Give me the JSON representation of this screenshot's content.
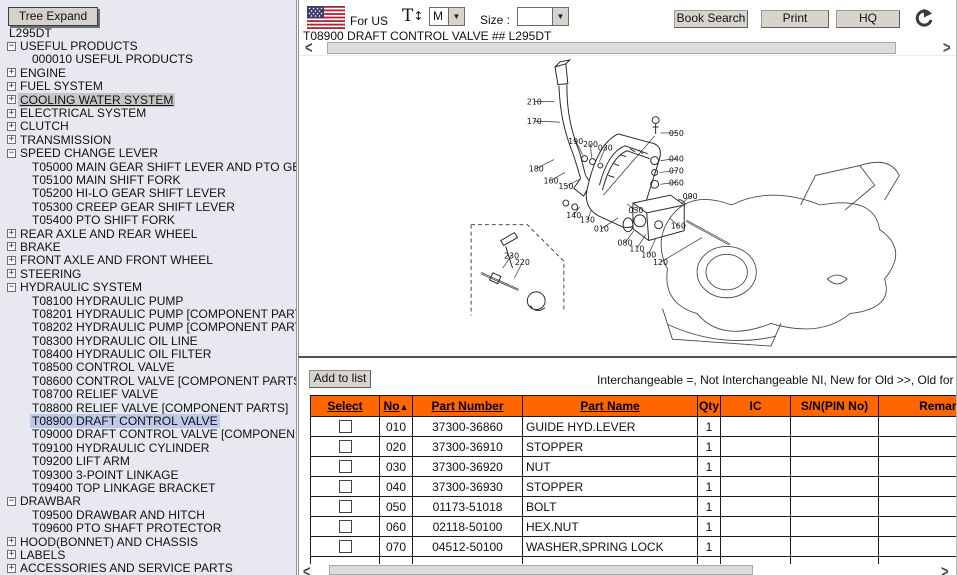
{
  "tree": {
    "expand_button_label": "Tree Expand",
    "items": [
      {
        "label": "L295DT",
        "icon": "none",
        "level": 0,
        "state": "normal"
      },
      {
        "label": "USEFUL PRODUCTS",
        "icon": "minus",
        "level": 0,
        "state": "normal"
      },
      {
        "label": "000010 USEFUL PRODUCTS",
        "icon": "none",
        "level": 1,
        "state": "normal"
      },
      {
        "label": "ENGINE",
        "icon": "plus",
        "level": 0,
        "state": "normal"
      },
      {
        "label": "FUEL SYSTEM",
        "icon": "plus",
        "level": 0,
        "state": "normal"
      },
      {
        "label": "COOLING WATER SYSTEM",
        "icon": "plus",
        "level": 0,
        "state": "focused"
      },
      {
        "label": "ELECTRICAL SYSTEM",
        "icon": "plus",
        "level": 0,
        "state": "normal"
      },
      {
        "label": "CLUTCH",
        "icon": "plus",
        "level": 0,
        "state": "normal"
      },
      {
        "label": "TRANSMISSION",
        "icon": "plus",
        "level": 0,
        "state": "normal"
      },
      {
        "label": "SPEED CHANGE LEVER",
        "icon": "minus",
        "level": 0,
        "state": "normal"
      },
      {
        "label": "T05000 MAIN GEAR SHIFT LEVER AND PTO GE",
        "icon": "none",
        "level": 1,
        "state": "normal"
      },
      {
        "label": "T05100 MAIN SHIFT FORK",
        "icon": "none",
        "level": 1,
        "state": "normal"
      },
      {
        "label": "T05200 HI-LO GEAR SHIFT LEVER",
        "icon": "none",
        "level": 1,
        "state": "normal"
      },
      {
        "label": "T05300 CREEP GEAR SHIFT LEVER",
        "icon": "none",
        "level": 1,
        "state": "normal"
      },
      {
        "label": "T05400 PTO SHIFT FORK",
        "icon": "none",
        "level": 1,
        "state": "normal"
      },
      {
        "label": "REAR AXLE AND REAR WHEEL",
        "icon": "plus",
        "level": 0,
        "state": "normal"
      },
      {
        "label": "BRAKE",
        "icon": "plus",
        "level": 0,
        "state": "normal"
      },
      {
        "label": "FRONT AXLE AND FRONT WHEEL",
        "icon": "plus",
        "level": 0,
        "state": "normal"
      },
      {
        "label": "STEERING",
        "icon": "plus",
        "level": 0,
        "state": "normal"
      },
      {
        "label": "HYDRAULIC SYSTEM",
        "icon": "minus",
        "level": 0,
        "state": "normal"
      },
      {
        "label": "T08100 HYDRAULIC PUMP",
        "icon": "none",
        "level": 1,
        "state": "normal"
      },
      {
        "label": "T08201 HYDRAULIC PUMP [COMPONENT PART",
        "icon": "none",
        "level": 1,
        "state": "normal"
      },
      {
        "label": "T08202 HYDRAULIC PUMP [COMPONENT PART",
        "icon": "none",
        "level": 1,
        "state": "normal"
      },
      {
        "label": "T08300 HYDRAULIC OIL LINE",
        "icon": "none",
        "level": 1,
        "state": "normal"
      },
      {
        "label": "T08400 HYDRAULIC OIL FILTER",
        "icon": "none",
        "level": 1,
        "state": "normal"
      },
      {
        "label": "T08500 CONTROL VALVE",
        "icon": "none",
        "level": 1,
        "state": "normal"
      },
      {
        "label": "T08600 CONTROL VALVE [COMPONENT PARTS",
        "icon": "none",
        "level": 1,
        "state": "normal"
      },
      {
        "label": "T08700 RELIEF VALVE",
        "icon": "none",
        "level": 1,
        "state": "normal"
      },
      {
        "label": "T08800 RELIEF VALVE [COMPONENT PARTS]",
        "icon": "none",
        "level": 1,
        "state": "normal"
      },
      {
        "label": "T08900 DRAFT CONTROL VALVE",
        "icon": "none",
        "level": 1,
        "state": "selected"
      },
      {
        "label": "T09000 DRAFT CONTROL VALVE [COMPONEN",
        "icon": "none",
        "level": 1,
        "state": "normal"
      },
      {
        "label": "T09100 HYDRAULIC CYLINDER",
        "icon": "none",
        "level": 1,
        "state": "normal"
      },
      {
        "label": "T09200 LIFT ARM",
        "icon": "none",
        "level": 1,
        "state": "normal"
      },
      {
        "label": "T09300 3-POINT LINKAGE",
        "icon": "none",
        "level": 1,
        "state": "normal"
      },
      {
        "label": "T09400 TOP LINKAGE BRACKET",
        "icon": "none",
        "level": 1,
        "state": "normal"
      },
      {
        "label": "DRAWBAR",
        "icon": "minus",
        "level": 0,
        "state": "normal"
      },
      {
        "label": "T09500 DRAWBAR AND HITCH",
        "icon": "none",
        "level": 1,
        "state": "normal"
      },
      {
        "label": "T09600 PTO SHAFT PROTECTOR",
        "icon": "none",
        "level": 1,
        "state": "normal"
      },
      {
        "label": "HOOD(BONNET) AND CHASSIS",
        "icon": "plus",
        "level": 0,
        "state": "normal"
      },
      {
        "label": "LABELS",
        "icon": "plus",
        "level": 0,
        "state": "normal"
      },
      {
        "label": "ACCESSORIES AND SERVICE PARTS",
        "icon": "plus",
        "level": 0,
        "state": "normal"
      }
    ]
  },
  "toolbar": {
    "region_label": "For US",
    "text_size_icon": "T",
    "text_size_arrow": "↕",
    "font_size_value": "M",
    "size_label": "Size :",
    "size_value": "",
    "dropdown_arrow": "▼",
    "buttons": [
      "Book Search",
      "Print",
      "HQ"
    ],
    "icons": {
      "flag": "us-flag-icon",
      "refresh": "refresh-icon"
    }
  },
  "scrollbars": {
    "left_arrow": "<",
    "right_arrow": ">"
  },
  "diagram": {
    "title": "T08900 DRAFT CONTROL VALVE ## L295DT",
    "labels": [
      {
        "t": "210",
        "x": 230,
        "y": 48,
        "lx": 250,
        "ly": 45
      },
      {
        "t": "170",
        "x": 230,
        "y": 68,
        "lx": 256,
        "ly": 66
      },
      {
        "t": "190",
        "x": 272,
        "y": 88,
        "lx": 279,
        "ly": 99
      },
      {
        "t": "200",
        "x": 287,
        "y": 91,
        "lx": 288,
        "ly": 102
      },
      {
        "t": "030",
        "x": 302,
        "y": 95,
        "lx": 296,
        "ly": 106
      },
      {
        "t": "050",
        "x": 374,
        "y": 80,
        "lx": 358,
        "ly": 77
      },
      {
        "t": "040",
        "x": 374,
        "y": 106,
        "lx": 358,
        "ly": 105
      },
      {
        "t": "070",
        "x": 374,
        "y": 118,
        "lx": 357,
        "ly": 117
      },
      {
        "t": "060",
        "x": 374,
        "y": 130,
        "lx": 358,
        "ly": 129
      },
      {
        "t": "180",
        "x": 232,
        "y": 116,
        "lx": 250,
        "ly": 104
      },
      {
        "t": "160",
        "x": 247,
        "y": 128,
        "lx": 261,
        "ly": 117
      },
      {
        "t": "150",
        "x": 262,
        "y": 134,
        "lx": 276,
        "ly": 124
      },
      {
        "t": "090",
        "x": 388,
        "y": 144,
        "lx": 379,
        "ly": 149
      },
      {
        "t": "030",
        "x": 333,
        "y": 158,
        "lx": 324,
        "ly": 149
      },
      {
        "t": "160",
        "x": 376,
        "y": 174,
        "lx": 367,
        "ly": 163
      },
      {
        "t": "140",
        "x": 270,
        "y": 163,
        "lx": 276,
        "ly": 152
      },
      {
        "t": "130",
        "x": 284,
        "y": 168,
        "lx": 288,
        "ly": 155
      },
      {
        "t": "010",
        "x": 298,
        "y": 177,
        "lx": 315,
        "ly": 163
      },
      {
        "t": "080",
        "x": 322,
        "y": 191,
        "lx": 331,
        "ly": 176
      },
      {
        "t": "110",
        "x": 334,
        "y": 197,
        "lx": 343,
        "ly": 180
      },
      {
        "t": "100",
        "x": 346,
        "y": 203,
        "lx": 353,
        "ly": 184
      },
      {
        "t": "120",
        "x": 358,
        "y": 211,
        "lx": 400,
        "ly": 183
      },
      {
        "t": "230",
        "x": 207,
        "y": 204,
        "lx": 198,
        "ly": 214
      },
      {
        "t": "220",
        "x": 218,
        "y": 211,
        "lx": 210,
        "ly": 224
      }
    ]
  },
  "parts_panel": {
    "add_to_list_label": "Add to list",
    "legend": "Interchangeable =, Not Interchangeable NI, New for Old >>, Old for New <<",
    "sort_asc_icon": "▲",
    "columns": [
      {
        "label": "Select",
        "sortable": true,
        "sorted": false
      },
      {
        "label": "No",
        "sortable": true,
        "sorted": true
      },
      {
        "label": "Part Number",
        "sortable": true,
        "sorted": false
      },
      {
        "label": "Part Name",
        "sortable": true,
        "sorted": false
      },
      {
        "label": "Qty",
        "sortable": false,
        "sorted": false
      },
      {
        "label": "IC",
        "sortable": false,
        "sorted": false
      },
      {
        "label": "S/N(PIN No)",
        "sortable": false,
        "sorted": false
      },
      {
        "label": "Remarks",
        "sortable": false,
        "sorted": false
      }
    ],
    "rows": [
      {
        "no": "010",
        "part_number": "37300-36860",
        "part_name": "GUIDE HYD.LEVER",
        "qty": "1",
        "ic": "",
        "sn_pin": "",
        "remarks": ""
      },
      {
        "no": "020",
        "part_number": "37300-36910",
        "part_name": "STOPPER",
        "qty": "1",
        "ic": "",
        "sn_pin": "",
        "remarks": ""
      },
      {
        "no": "030",
        "part_number": "37300-36920",
        "part_name": "NUT",
        "qty": "1",
        "ic": "",
        "sn_pin": "",
        "remarks": ""
      },
      {
        "no": "040",
        "part_number": "37300-36930",
        "part_name": "STOPPER",
        "qty": "1",
        "ic": "",
        "sn_pin": "",
        "remarks": ""
      },
      {
        "no": "050",
        "part_number": "01173-51018",
        "part_name": "BOLT",
        "qty": "1",
        "ic": "",
        "sn_pin": "",
        "remarks": ""
      },
      {
        "no": "060",
        "part_number": "02118-50100",
        "part_name": "HEX.NUT",
        "qty": "1",
        "ic": "",
        "sn_pin": "",
        "remarks": ""
      },
      {
        "no": "070",
        "part_number": "04512-50100",
        "part_name": "WASHER,SPRING LOCK",
        "qty": "1",
        "ic": "",
        "sn_pin": "",
        "remarks": ""
      }
    ]
  }
}
